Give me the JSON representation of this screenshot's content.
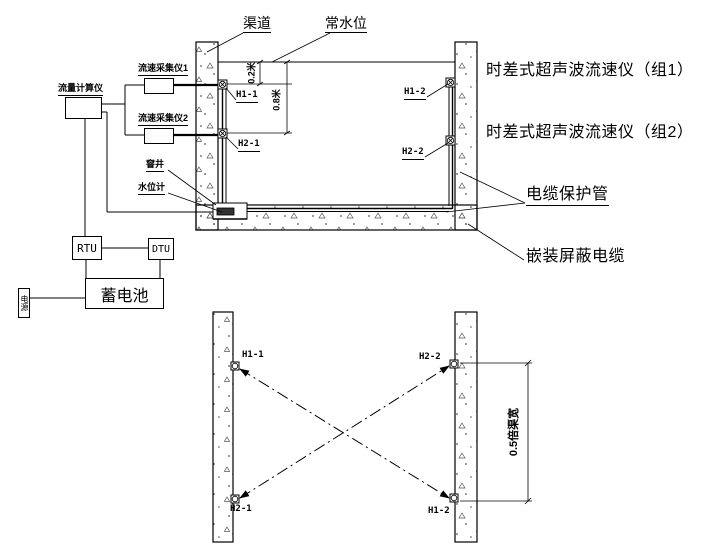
{
  "section": {
    "canal": "渠道",
    "water_level": "常水位",
    "collector1": "流速采集仪1",
    "collector2": "流速采集仪2",
    "flow_computer": "流量计算仪",
    "well": "窨井",
    "water_gauge": "水位计",
    "h11": "H1-1",
    "h21": "H2-1",
    "h12": "H1-2",
    "h22": "H2-2",
    "dim_top": "0.2米",
    "dim_mid": "0.8米",
    "label_group1": "时差式超声波流速仪（组1）",
    "label_group2": "时差式超声波流速仪（组2）",
    "label_cable_tube": "电缆保护管",
    "label_shielded_cable": "嵌装屏蔽电缆"
  },
  "power": {
    "rtu": "RTU",
    "dtu": "DTU",
    "battery": "蓄电池",
    "source": "电源"
  },
  "plan": {
    "h11": "H1-1",
    "h21": "H2-1",
    "h22": "H2-2",
    "h12": "H1-2",
    "dim_width": "0.5倍渠宽"
  },
  "colors": {
    "line": "#000000",
    "bg": "#ffffff"
  }
}
